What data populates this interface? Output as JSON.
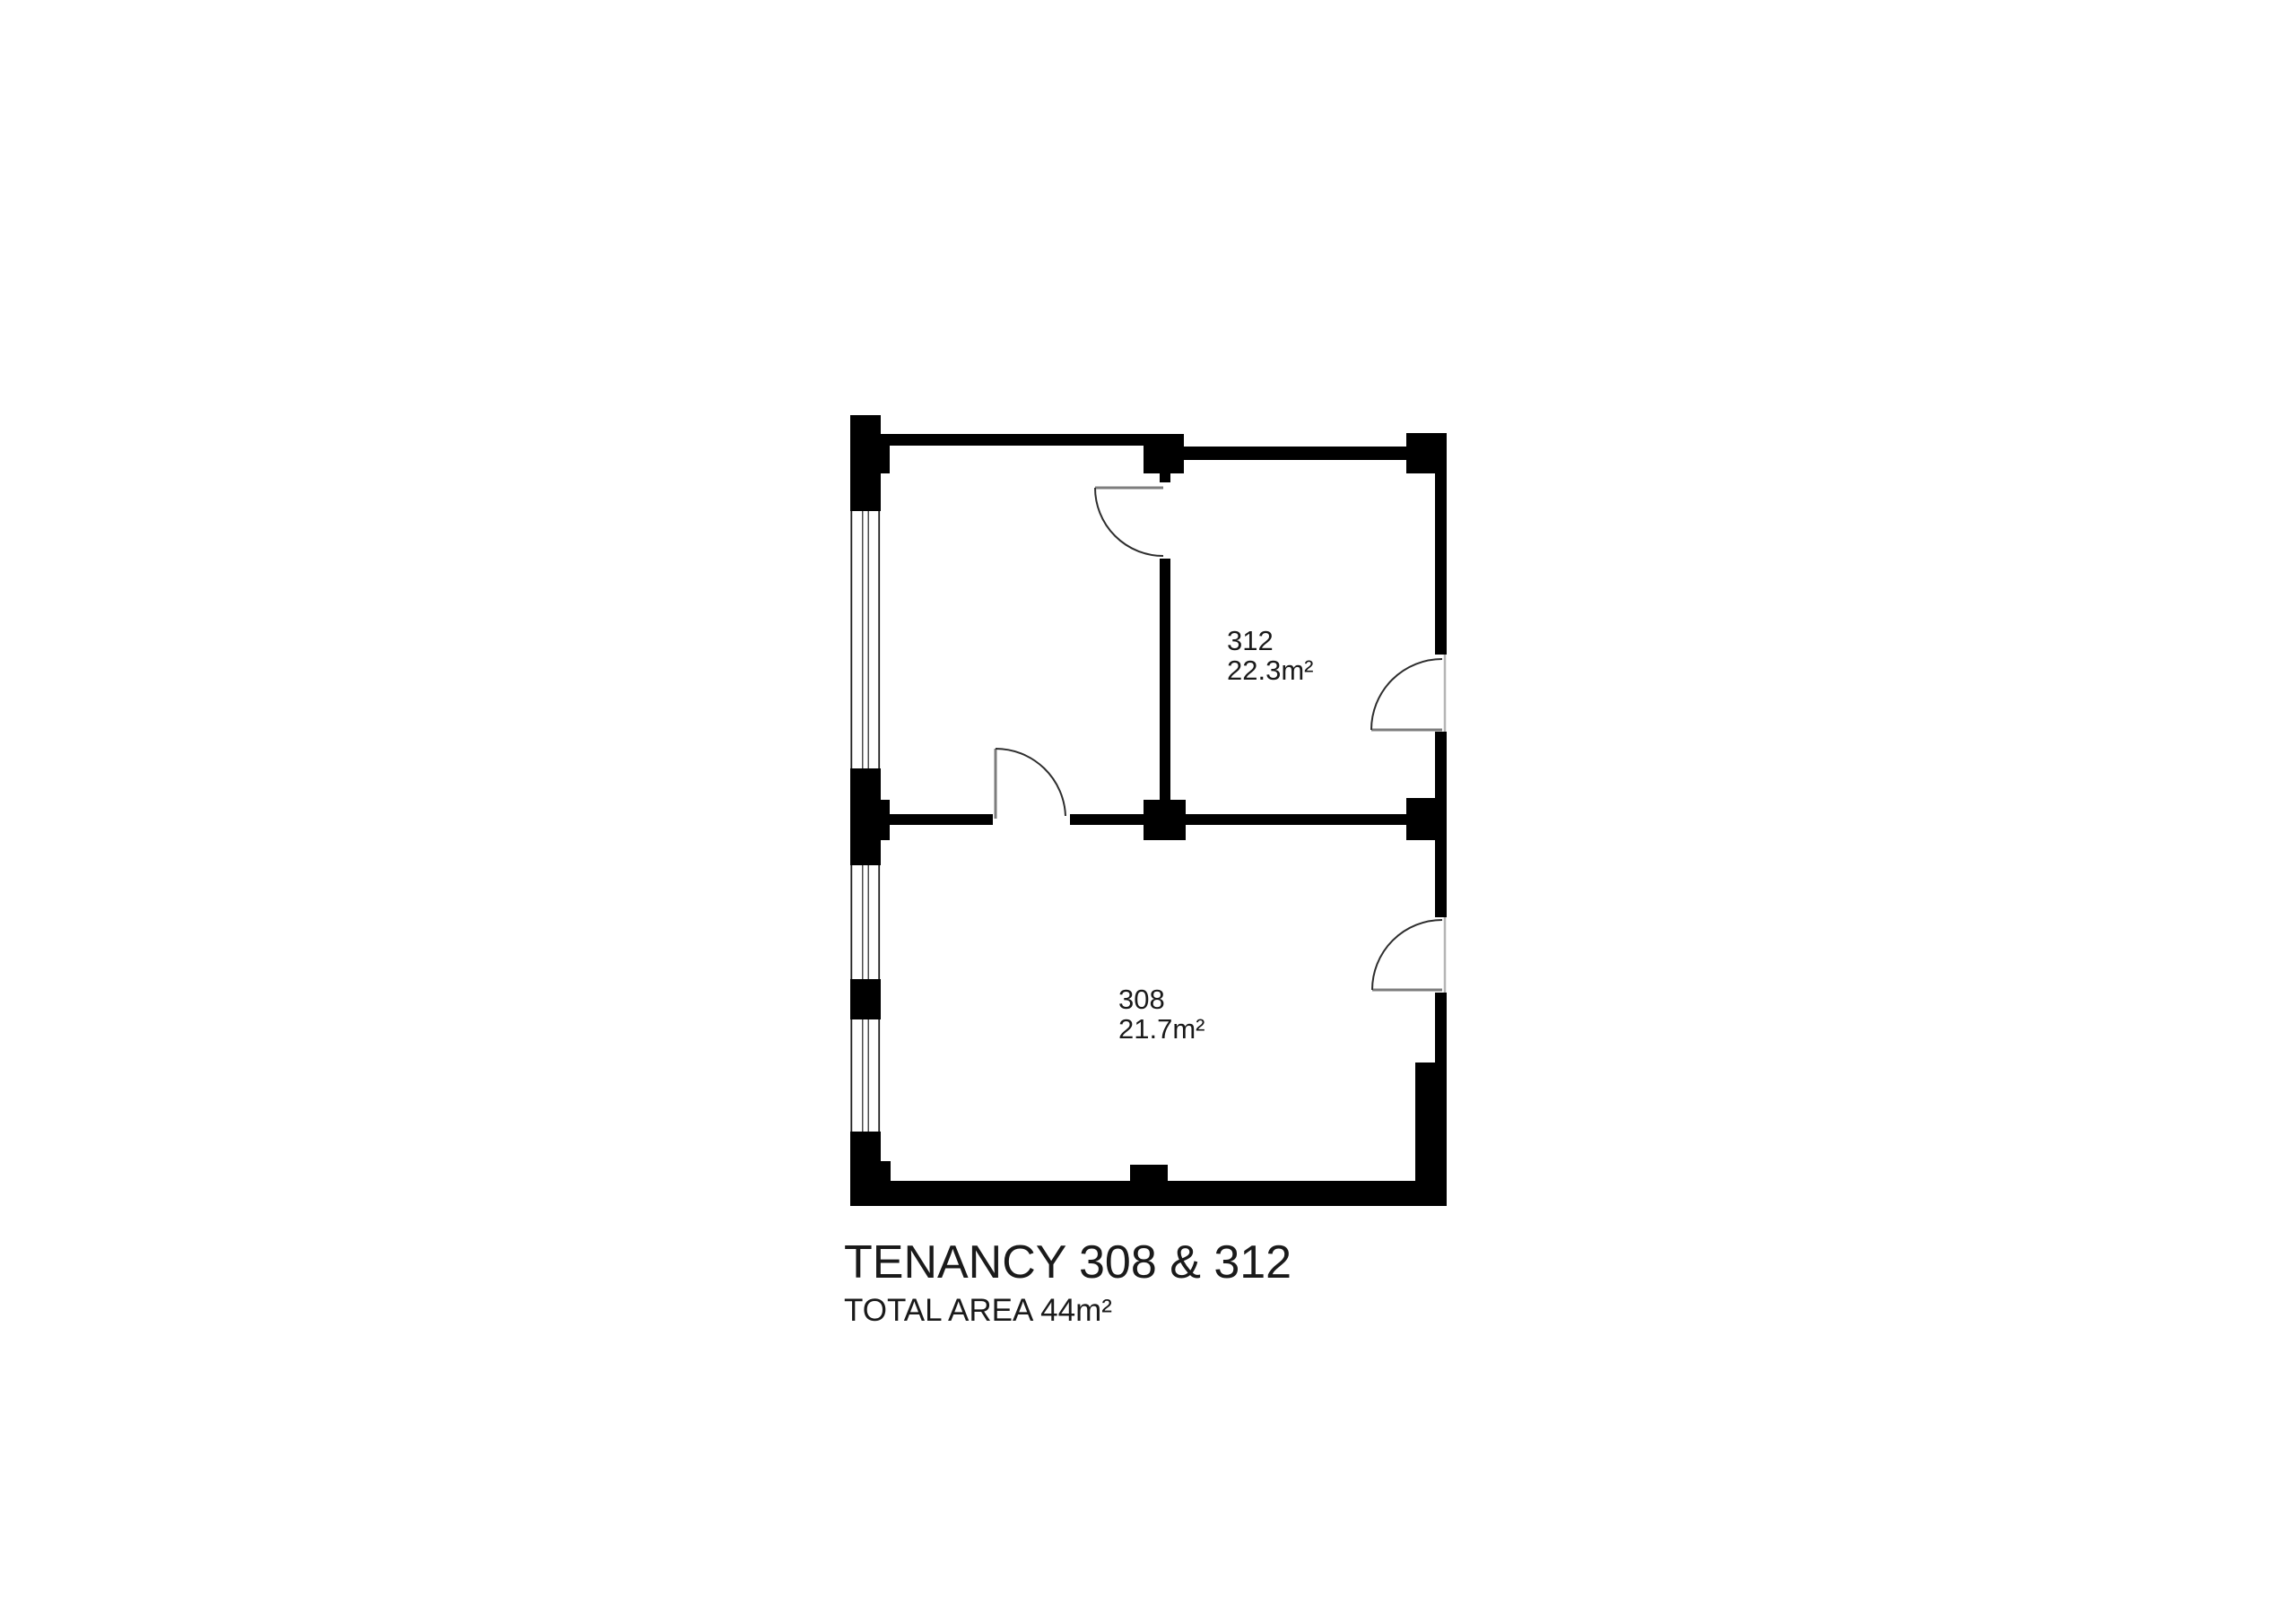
{
  "floorplan": {
    "title": "TENANCY 308 & 312",
    "subtitle": "TOTAL AREA 44m²",
    "rooms": [
      {
        "number": "312",
        "area": "22.3m²"
      },
      {
        "number": "308",
        "area": "21.7m²"
      }
    ],
    "colors": {
      "wall": "#000000",
      "background": "#ffffff",
      "text": "#1a1a1a",
      "door-arc": "#2e2e2e",
      "door-panel": "#7d7d7d",
      "opening-line": "#b5b5b5",
      "window-line": "#1f1f1f"
    }
  }
}
